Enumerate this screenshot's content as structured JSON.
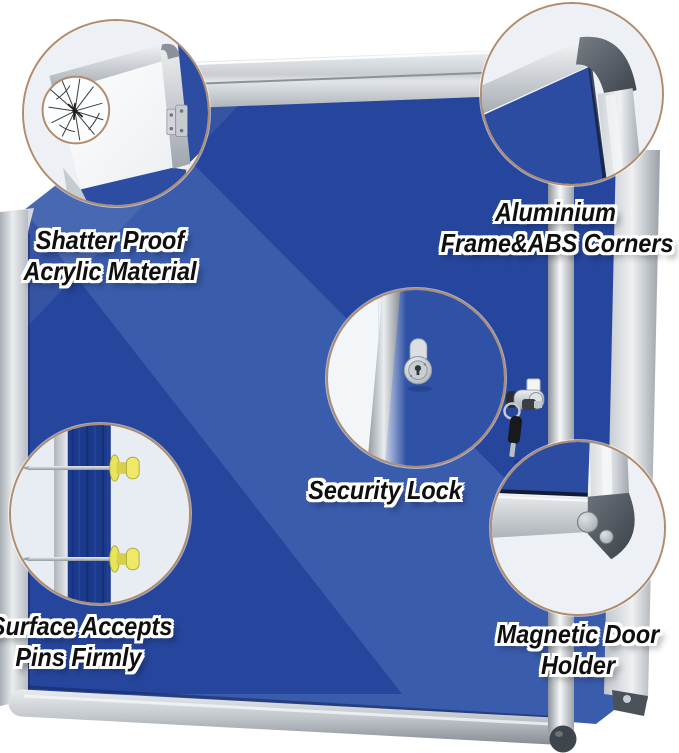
{
  "title": "Enclosed notice board product feature image",
  "features": [
    {
      "name": "shatter-proof-acrylic",
      "line1": "Shatter Proof",
      "line2": "Acrylic Material"
    },
    {
      "name": "aluminium-frame",
      "line1": "Aluminium",
      "line2": "Frame&ABS Corners"
    },
    {
      "name": "security-lock",
      "line1": "Security Lock",
      "line2": ""
    },
    {
      "name": "pin-surface",
      "line1": "Surface Accepts",
      "line2": "Pins Firmly"
    },
    {
      "name": "magnetic-door-holder",
      "line1": "Magnetic Door",
      "line2": "Holder"
    }
  ],
  "colors": {
    "felt_blue_light": "#3a5cac",
    "felt_blue_dark": "#26469d",
    "felt_navy_strip": "#1c3a8c",
    "frame_silver": "#c9ced3",
    "abs_corner_gray": "#464c53",
    "callout_ring_tan": "#b18c6c",
    "callout_background": "#edf1f6",
    "pin_yellow": "#eae45b",
    "label_text": "#0f0f0f",
    "label_outline": "#ffffff"
  }
}
